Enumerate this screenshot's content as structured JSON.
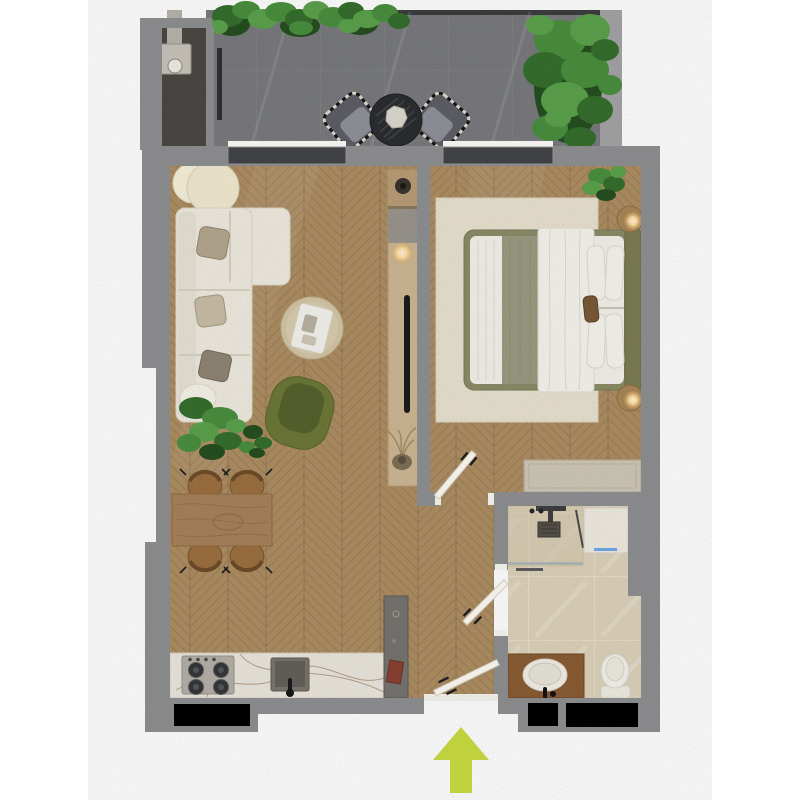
{
  "meta": {
    "type": "apartment-floor-plan",
    "view": "top-down render",
    "entry_direction": "up"
  },
  "colors": {
    "background": "#ffffff",
    "wall": "#8b8c8e",
    "wall_light": "#a4a4a6",
    "window_frame_dark": "#3f4144",
    "window_black": "#000000",
    "balcony_floor": "#797a7d",
    "balcony_alcove": "#4b4743",
    "wood_floor": "#ae8e63",
    "bathroom_floor": "#ddd2ba",
    "rug": "#e9e2cf",
    "sofa": "#efebe0",
    "armchair": "#6d7838",
    "armchair_seat": "#55622c",
    "bed_frame": "#8b8c67",
    "bedding_white": "#f3f1ea",
    "bed_runner": "#9a9b82",
    "headboard": "#7c7d55",
    "counter_marble": "#ebe7de",
    "table_wood": "#a8825a",
    "chair_tan": "#9c7040",
    "vanity_wood": "#8a5c32",
    "lamp_glow": "#ffdda2",
    "door_leaf": "#f2efe8",
    "entry_arrow": "#bfd23e",
    "plant_green": "#4a8f3e",
    "tree_green": "#4c9440",
    "balcony_chair": "#5e5f66",
    "balcony_table": "#2b2d30"
  },
  "legend": {
    "rooms": [
      "balcony",
      "living-room",
      "kitchen",
      "dining-area",
      "bedroom",
      "bathroom",
      "entry-hall"
    ],
    "balcony_items": [
      "hedge-plants",
      "downpipe",
      "lounge-chair",
      "lounge-chair",
      "round-table",
      "tree"
    ],
    "living_items": [
      "floor-lamp",
      "corner-sofa",
      "coffee-table",
      "armchair",
      "plants",
      "dining-table",
      "dining-chairs",
      "tv-console",
      "tv",
      "console-lamp",
      "dried-plant"
    ],
    "kitchen_items": [
      "marble-counter",
      "stove",
      "sink",
      "tall-cabinet"
    ],
    "bedroom_items": [
      "rug",
      "bed",
      "pillows",
      "headboard",
      "nightstand-lamp",
      "nightstand-lamp",
      "plant",
      "dresser",
      "bedroom-door"
    ],
    "bathroom_items": [
      "shower",
      "washing-machine",
      "vanity-sink",
      "toilet",
      "bathroom-door"
    ],
    "entry_items": [
      "entry-door",
      "threshold",
      "entry-arrow"
    ]
  }
}
